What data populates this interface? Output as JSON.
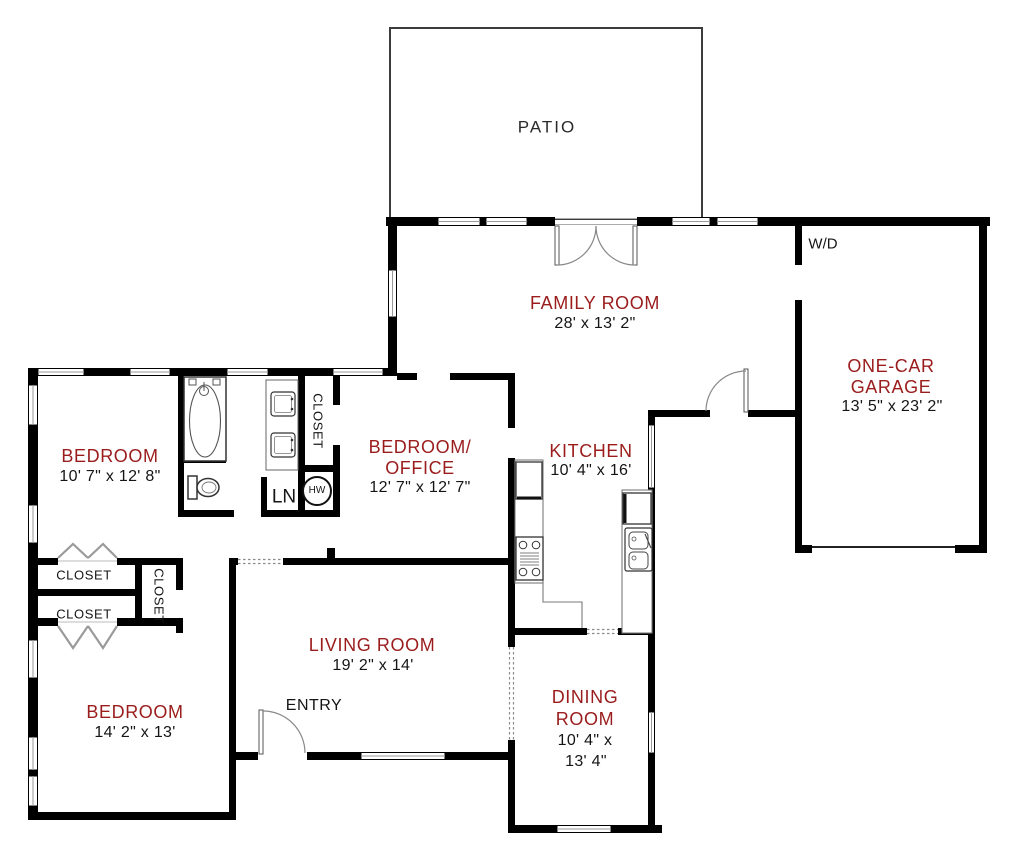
{
  "plan_title": "Single-story house floor plan",
  "colors": {
    "wall": "#000000",
    "room_label": "#9a1c1c",
    "dimension_text": "#151515",
    "background": "#ffffff"
  },
  "rooms": {
    "patio": {
      "name": "PATIO"
    },
    "family_room": {
      "name": "FAMILY ROOM",
      "dimensions": "28' x 13' 2\""
    },
    "garage": {
      "line1": "ONE-CAR",
      "line2": "GARAGE",
      "dimensions": "13' 5\" x 23' 2\""
    },
    "bedroom_top": {
      "name": "BEDROOM",
      "dimensions": "10' 7\" x 12' 8\""
    },
    "bedroom_office": {
      "line1": "BEDROOM/",
      "line2": "OFFICE",
      "dimensions": "12' 7\" x 12' 7\""
    },
    "kitchen": {
      "name": "KITCHEN",
      "dimensions": "10' 4\" x 16'"
    },
    "living_room": {
      "name": "LIVING ROOM",
      "dimensions": "19' 2\" x 14'"
    },
    "dining_room": {
      "line1": "DINING",
      "line2": "ROOM",
      "dim_line1": "10' 4\" x",
      "dim_line2": "13' 4\""
    },
    "bedroom_bottom": {
      "name": "BEDROOM",
      "dimensions": "14' 2\" x 13'"
    }
  },
  "closets": {
    "upper": "CLOSET",
    "lower": "CLOSET",
    "hall": "CLOSET",
    "bath": "CLOSET"
  },
  "annotations": {
    "washer_dryer": "W/D",
    "entry": "ENTRY",
    "linen": "LN",
    "water_heater": "HW"
  }
}
